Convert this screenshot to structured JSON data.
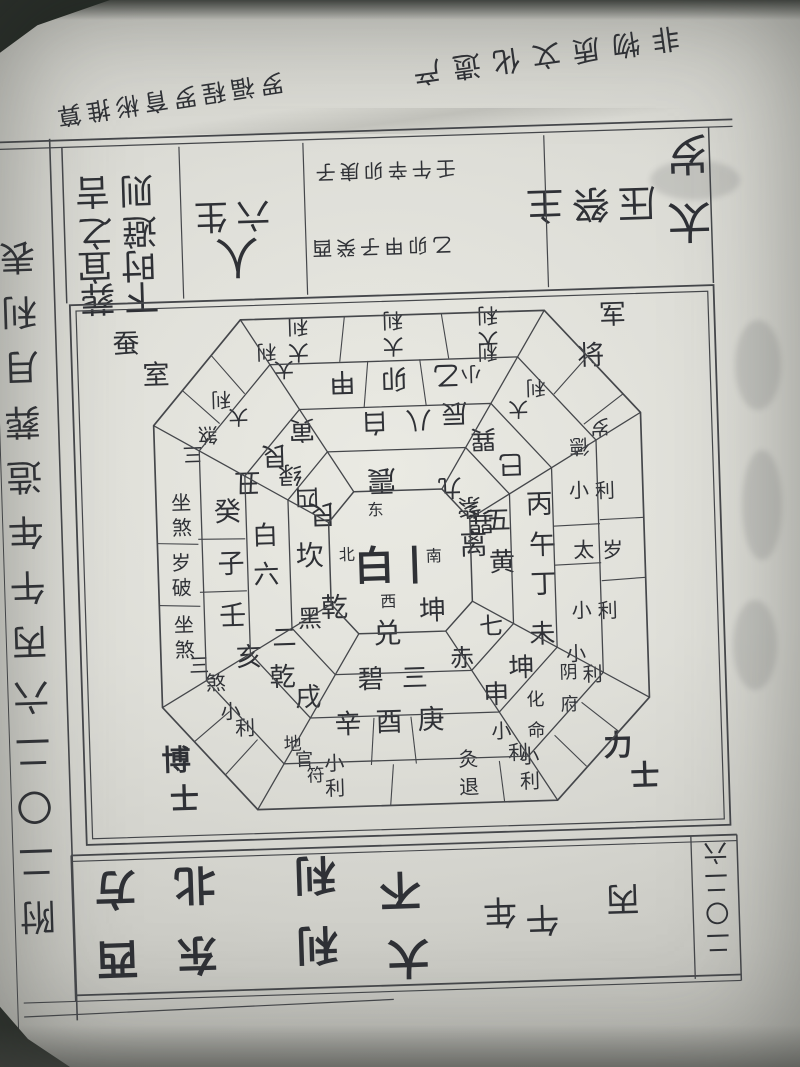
{
  "page": {
    "credit": "罗福程 罗育彬推算",
    "heritage": "非物质文化遗产"
  },
  "taboo_band": {
    "taisui": "太岁",
    "press": "压祭主",
    "ganzhi_row1": "壬午辛卯庚子",
    "ganzhi_row2": "乙卯甲子癸酉",
    "persons_small": "六生",
    "persons_big": "人",
    "avoid_line1": "避之",
    "avoid_line2": "则吉",
    "burial_line1": "下葬",
    "burial_line2": "时宜"
  },
  "chart": {
    "center": {
      "star": "一白",
      "dir_east": "东",
      "dir_north": "北",
      "dir_south": "南",
      "dir_west": "西"
    },
    "corners": {
      "top_left": "蚕室",
      "top_right": "将军",
      "bottom_left": "博士",
      "bottom_right": "力士"
    },
    "sectors": {
      "zhen_e": {
        "trigram": "震",
        "star": "八白",
        "mountains": "甲卯乙",
        "band": [
          "大利",
          "大利",
          "大利"
        ]
      },
      "gen_ne": {
        "trigram": "艮",
        "star": "四绿",
        "mountains": "丑艮寅",
        "band": [
          "三煞",
          "大利",
          "大利"
        ]
      },
      "xun_se": {
        "trigram": "巽",
        "star": "九紫",
        "mountains": "辰巽巳",
        "band": [
          "小利",
          "大利",
          "岁德"
        ]
      },
      "li_s": {
        "trigram": "离",
        "star": "五黄",
        "mountains": "丙午丁",
        "band": [
          "小利",
          "太岁",
          "小利"
        ]
      },
      "kan_n": {
        "trigram": "坎",
        "star": "六白",
        "mountains": "壬子癸",
        "band": [
          "坐煞",
          "岁破",
          "坐煞"
        ]
      },
      "qian_nw": {
        "trigram": "乾",
        "star": "二黑",
        "mountains": "戌乾亥",
        "band": [
          "三煞",
          "小利",
          "地官符"
        ]
      },
      "dui_w": {
        "trigram": "兑",
        "star": "三碧",
        "mountains": "庚酉辛",
        "band": [
          "小利",
          "灸退",
          "小利"
        ]
      },
      "kun_sw": {
        "trigram": "坤",
        "star": "七赤",
        "mountains": "未坤申",
        "band": [
          "小利",
          "阴府",
          "化命",
          "小利"
        ]
      }
    }
  },
  "year_band": {
    "year": "二〇二六",
    "ganzhi_year": "丙午年",
    "favorable": "大利",
    "favorable_dirs": "东西",
    "unfavorable": "不利",
    "unfavorable_dirs": "北方"
  },
  "side_strip": {
    "text": "附二〇二六丙午年造葬月利表"
  }
}
